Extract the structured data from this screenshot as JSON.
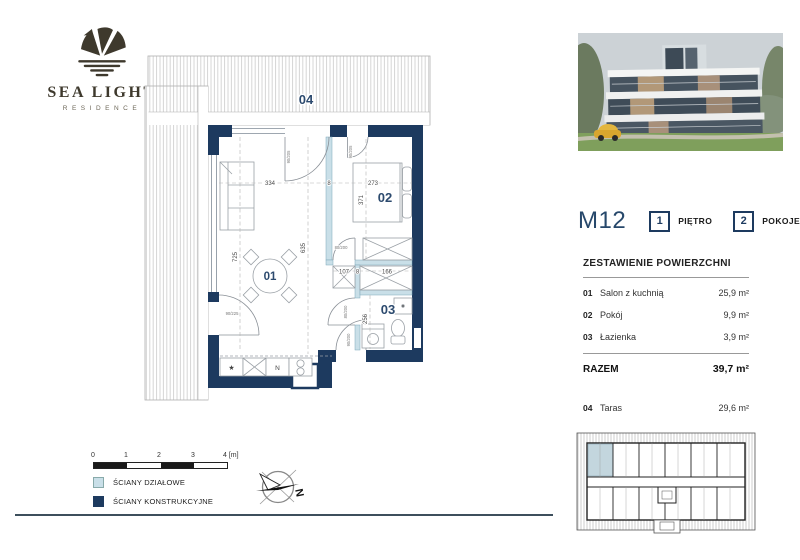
{
  "brand": {
    "name": "SEA LIGHT",
    "tagline": "RESIDENCE"
  },
  "unit": {
    "code": "M12",
    "floor": {
      "value": "1",
      "label": "PIĘTRO"
    },
    "rooms": {
      "value": "2",
      "label": "POKOJE"
    }
  },
  "area_table": {
    "title": "ZESTAWIENIE POWIERZCHNI",
    "rows": [
      {
        "num": "01",
        "name": "Salon z kuchnią",
        "value": "25,9 m²"
      },
      {
        "num": "02",
        "name": "Pokój",
        "value": "9,9 m²"
      },
      {
        "num": "03",
        "name": "Łazienka",
        "value": "3,9 m²"
      }
    ],
    "total": {
      "label": "RAZEM",
      "value": "39,7 m²"
    },
    "extra": {
      "num": "04",
      "name": "Taras",
      "value": "29,6 m²"
    }
  },
  "plan": {
    "room_labels": [
      {
        "id": "terrace",
        "text": "04"
      },
      {
        "id": "living",
        "text": "01"
      },
      {
        "id": "bedroom",
        "text": "02"
      },
      {
        "id": "bathroom",
        "text": "03"
      }
    ],
    "dims": [
      "334",
      "8",
      "273",
      "371",
      "725",
      "635",
      "107",
      "8",
      "166",
      "256"
    ],
    "door_labels": [
      "90/205",
      "90/205",
      "90/225",
      "80/200",
      "80/200",
      "90/200"
    ],
    "kitchen": {
      "star": "★",
      "fridge_letter": "N"
    }
  },
  "legend": {
    "scale_ticks": [
      "0",
      "1",
      "2",
      "3",
      "4 [m]"
    ],
    "items": [
      {
        "label": "ŚCIANY DZIAŁOWE",
        "color": "#c9dfe8"
      },
      {
        "label": "ŚCIANY KONSTRUKCYJNE",
        "color": "#1d3a5f"
      }
    ]
  },
  "compass": {
    "north": "N"
  },
  "colors": {
    "wall_structural": "#1d3a5f",
    "wall_partition": "#c9dfe8",
    "accent_navy": "#27486b",
    "logo_brown": "#3e392d"
  }
}
